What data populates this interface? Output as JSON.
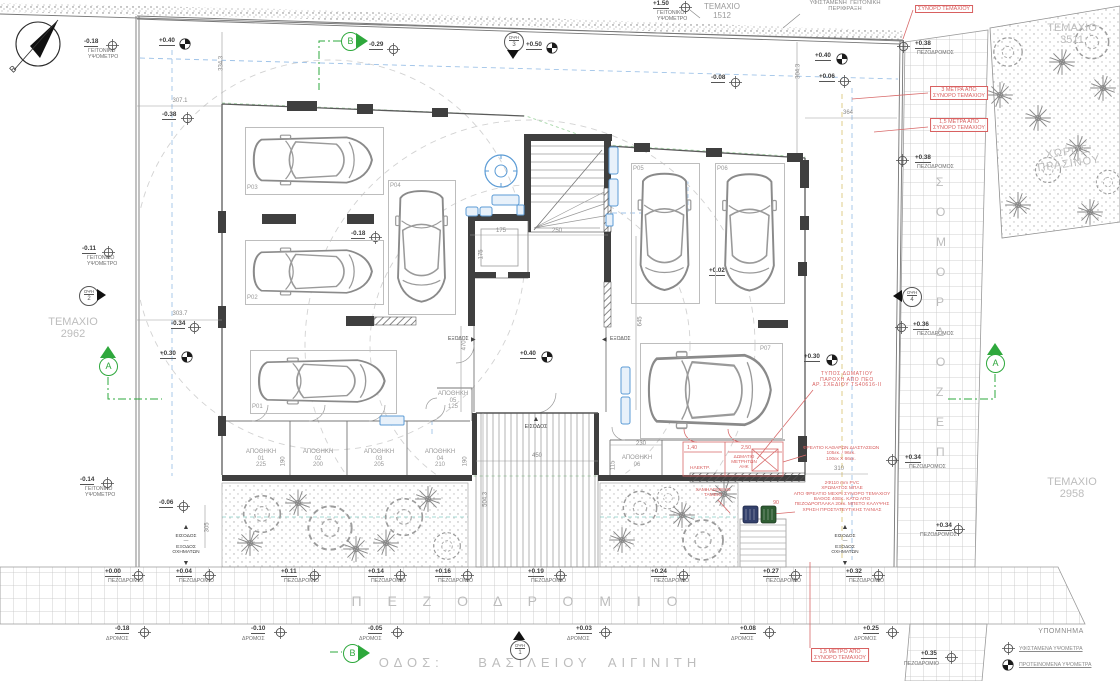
{
  "colors": {
    "accent_green": "#2ea83c",
    "annotation_red": "#d86060",
    "fixture_blue": "#5b9bd5",
    "line_gray": "#8a8a8a",
    "light_gray": "#bdbdbd",
    "wall_dark": "#3f3f3f"
  },
  "legend": {
    "title": "ΥΠΟΜΝΗΜΑ",
    "items": [
      {
        "sym": "existing",
        "text": "ΥΦΙΣΤΑΜΕΝΑ ΥΨΟΜΕΤΡΑ"
      },
      {
        "sym": "proposed",
        "text": "ΠΡΟΤΕΙΝΟΜΕΝΑ ΥΨΟΜΕΤΡΑ"
      }
    ]
  },
  "view_marker_label": "ΟΨΗ",
  "sidewalk_strip": {
    "letters": [
      "Σ",
      "Ο",
      "Μ",
      "Ο",
      "Ρ",
      "Δ",
      "Ο",
      "Ζ",
      "Ε",
      "Π"
    ],
    "x": 936,
    "y0": 176,
    "dy": 30
  },
  "labels": [
    {
      "t": "B",
      "x": 10,
      "y": 64,
      "c": "k",
      "s": 9,
      "rot": -45,
      "n": "compass-north-label"
    },
    {
      "t": "307.1",
      "x": 180,
      "y": 98,
      "a": "c",
      "n": "dimension-label"
    },
    {
      "t": "334.3",
      "x": 222,
      "y": 60,
      "a": "c",
      "rot": -90,
      "n": "dimension-label"
    },
    {
      "t": "304.3",
      "x": 799,
      "y": 68,
      "a": "c",
      "rot": -90,
      "n": "dimension-label"
    },
    {
      "t": "364",
      "x": 848,
      "y": 110,
      "a": "c",
      "n": "dimension-label"
    },
    {
      "t": "303.7",
      "x": 180,
      "y": 311,
      "a": "c",
      "n": "dimension-label"
    },
    {
      "t": "175",
      "x": 501,
      "y": 228,
      "a": "c",
      "n": "dimension-label"
    },
    {
      "t": "250",
      "x": 557,
      "y": 228,
      "a": "c",
      "n": "dimension-label"
    },
    {
      "t": "175",
      "x": 482,
      "y": 251,
      "a": "c",
      "rot": -90,
      "n": "dimension-label"
    },
    {
      "t": "645",
      "x": 641,
      "y": 318,
      "a": "c",
      "rot": -90,
      "n": "dimension-label"
    },
    {
      "t": "470",
      "x": 465,
      "y": 342,
      "a": "c",
      "rot": -90,
      "n": "dimension-label"
    },
    {
      "t": "504.3",
      "x": 486,
      "y": 496,
      "a": "c",
      "rot": -90,
      "n": "dimension-label"
    },
    {
      "t": "450",
      "x": 537,
      "y": 453,
      "a": "c",
      "n": "dimension-label"
    },
    {
      "t": "310",
      "x": 839,
      "y": 466,
      "a": "c",
      "n": "dimension-label"
    },
    {
      "t": "230",
      "x": 641,
      "y": 441,
      "a": "c",
      "n": "dimension-label"
    },
    {
      "t": "115",
      "x": 614,
      "y": 462,
      "a": "c",
      "rot": -90,
      "n": "dimension-label"
    },
    {
      "t": "190",
      "x": 284,
      "y": 458,
      "a": "c",
      "rot": -90,
      "n": "dimension-label"
    },
    {
      "t": "190",
      "x": 466,
      "y": 458,
      "a": "c",
      "rot": -90,
      "n": "dimension-label"
    },
    {
      "t": "305",
      "x": 208,
      "y": 524,
      "a": "c",
      "rot": -90,
      "n": "dimension-label"
    },
    {
      "t": "ΑΠΟΘΗΚΗ\n01\n225",
      "x": 261,
      "y": 449,
      "a": "c",
      "c": "g",
      "n": "room-label-apothiki-01"
    },
    {
      "t": "ΑΠΟΘΗΚΗ\n02\n200",
      "x": 318,
      "y": 449,
      "a": "c",
      "c": "g",
      "n": "room-label-apothiki-02"
    },
    {
      "t": "ΑΠΟΘΗΚΗ\n03\n205",
      "x": 379,
      "y": 449,
      "a": "c",
      "c": "g",
      "n": "room-label-apothiki-03"
    },
    {
      "t": "ΑΠΟΘΗΚΗ\n04\n210",
      "x": 440,
      "y": 449,
      "a": "c",
      "c": "g",
      "n": "room-label-apothiki-04"
    },
    {
      "t": "ΑΠΟΘΗΚΗ\n05\n125",
      "x": 453,
      "y": 391,
      "a": "c",
      "c": "g",
      "n": "room-label-apothiki-05"
    },
    {
      "t": "ΑΠΟΘΗΚΗ\n06",
      "x": 637,
      "y": 455,
      "a": "c",
      "c": "g",
      "n": "room-label-apothiki-06"
    },
    {
      "t": "ΤΕΜΑΧΙΟ\n1512",
      "x": 722,
      "y": 3,
      "a": "c",
      "c": "g",
      "s": 8,
      "n": "parcel-label-1512"
    },
    {
      "t": "ΤΕΜΑΧΙΟ\n3511",
      "x": 1072,
      "y": 22,
      "a": "c",
      "c": "lg",
      "s": 11,
      "n": "parcel-label-3511"
    },
    {
      "t": "ΤΕΜΑΧΙΟ\n2962",
      "x": 73,
      "y": 316,
      "a": "c",
      "c": "lg",
      "s": 11,
      "n": "parcel-label-2962"
    },
    {
      "t": "ΤΕΜΑΧΙΟ\n2958",
      "x": 1072,
      "y": 476,
      "a": "c",
      "c": "lg",
      "s": 11,
      "n": "parcel-label-2958"
    },
    {
      "t": "ΧΩΡΟΣ\nΠΡΑΣΙΝΟΥ",
      "x": 1068,
      "y": 146,
      "a": "c",
      "c": "lg",
      "s": 11,
      "rot": -8,
      "ls": 1,
      "n": "green-space-label"
    },
    {
      "t": "ΥΦΙΣΤΑΜΕΝΗ  ΓΕΙΤΟΝΙΚΗ\nΠΕΡΙΦΡΑΞΗ",
      "x": 845,
      "y": 0,
      "a": "c",
      "c": "d",
      "s": 5.8,
      "n": "existing-fence-label"
    },
    {
      "t": "Π Ε Ζ Ο Δ Ρ Ο Μ Ι Ο",
      "x": 520,
      "y": 594,
      "a": "c",
      "c": "lg",
      "s": 14,
      "ls": 11,
      "n": "sidewalk-watermark"
    },
    {
      "t": "ΟΔΟΣ:    ΒΑΣΙΛΕΙΟΥ  ΑΙΓΙΝΙΤΗ",
      "x": 540,
      "y": 656,
      "a": "c",
      "c": "lg",
      "s": 13,
      "ls": 5,
      "n": "street-name"
    },
    {
      "t": "ΕΙΣΟΔΟΣ",
      "x": 536,
      "y": 425,
      "a": "c",
      "c": "k",
      "s": 5.2,
      "n": "entrance-label"
    },
    {
      "t": "▲",
      "x": 536,
      "y": 416,
      "a": "c",
      "c": "k",
      "s": 7,
      "n": "entrance-arrow-icon"
    },
    {
      "t": "ΕΙΣΟΔΟΣ\n—\nΕΞΟΔΟΣ\nΟΧΗΜΑΤΩΝ",
      "x": 186,
      "y": 534,
      "a": "c",
      "c": "k",
      "s": 4.8,
      "n": "vehicle-entry-exit-left"
    },
    {
      "t": "▲",
      "x": 186,
      "y": 524,
      "a": "c",
      "c": "k",
      "s": 7,
      "n": "arrow-up-icon"
    },
    {
      "t": "▼",
      "x": 186,
      "y": 560,
      "a": "c",
      "c": "k",
      "s": 7,
      "n": "arrow-down-icon"
    },
    {
      "t": "ΕΙΣΟΔΟΣ\n—\nΕΞΟΔΟΣ\nΟΧΗΜΑΤΩΝ",
      "x": 845,
      "y": 534,
      "a": "c",
      "c": "k",
      "s": 4.8,
      "n": "vehicle-entry-exit-right"
    },
    {
      "t": "▲",
      "x": 845,
      "y": 524,
      "a": "c",
      "c": "k",
      "s": 7,
      "n": "arrow-up-icon"
    },
    {
      "t": "▼",
      "x": 845,
      "y": 560,
      "a": "c",
      "c": "k",
      "s": 7,
      "n": "arrow-down-icon"
    },
    {
      "t": "ΕΞΟΔΟΣ",
      "x": 448,
      "y": 337,
      "c": "k",
      "s": 5,
      "n": "exit-label-left"
    },
    {
      "t": "▶",
      "x": 471,
      "y": 337,
      "c": "k",
      "s": 6,
      "n": "arrow-right-icon"
    },
    {
      "t": "◀",
      "x": 602,
      "y": 337,
      "c": "k",
      "s": 6,
      "n": "arrow-left-icon"
    },
    {
      "t": "ΕΞΟΔΟΣ",
      "x": 610,
      "y": 337,
      "c": "k",
      "s": 5,
      "n": "exit-label-right"
    },
    {
      "t": "ΣΥΝΟΡΟ ΤΕΜΑΧΙΟΥ",
      "x": 944,
      "y": 5,
      "a": "c",
      "c": "r",
      "s": 5.4,
      "box": 1,
      "n": "red-note-boundary"
    },
    {
      "t": "3 ΜΕΤΡΑ ΑΠΟ\nΣΥΝΟΡΟ ΤΕΜΑΧΙΟΥ",
      "x": 959,
      "y": 86,
      "a": "c",
      "c": "r",
      "s": 5.4,
      "box": 1,
      "n": "red-note-3m-setback"
    },
    {
      "t": "1,5 ΜΕΤΡΑ ΑΠΟ\nΣΥΝΟΡΟ ΤΕΜΑΧΙΟΥ",
      "x": 959,
      "y": 118,
      "a": "c",
      "c": "r",
      "s": 5.4,
      "box": 1,
      "n": "red-note-1-5m-setback"
    },
    {
      "t": "1,5 ΜΕΤΡΟ ΑΠΟ\nΣΥΝΟΡΟ ΤΕΜΑΧΙΟΥ",
      "x": 840,
      "y": 648,
      "a": "c",
      "c": "r",
      "s": 5.4,
      "box": 1,
      "n": "red-note-1-5m-bottom"
    },
    {
      "t": "ΤΥΠΟΣ ΔΩΜΑΤΙΟΥ\nΠΑΡΟΧΗ ΑΠΟ ΠΕΟ\nΑΡ. ΣΧΕΔΙΟΥ TS40616-II",
      "x": 847,
      "y": 372,
      "a": "c",
      "c": "r",
      "s": 5,
      "ls": 0.6,
      "n": "red-note-room-type"
    },
    {
      "t": "ΦΡΕΑΤΙΟ ΚΑΘΑΡΩΝ ΔΙΑΣΤΑΣΕΩΝ\n105εκ. / 96εκ.\n100εκ Χ 66εκ.",
      "x": 841,
      "y": 446,
      "a": "c",
      "c": "r",
      "s": 4.8,
      "n": "red-note-manhole"
    },
    {
      "t": "2Φ110 mm PVC\nΧΡΩΜΑΤΟΣ ΜΠΛΕ\nΑΠΟ ΦΡΕΑΤΙΟ ΜΕΧΡΙ ΣΥΝΟΡΟ ΤΕΜΑΧΙΟΥ\nΒΑΘΟΣ 40ΕΚ. ΚΑΤΩ ΑΠΟ\nΠΕΖΟΔΡΟΠΛΑΚΑ 20εκ. ΜΠΕΤΟ ΚΑΛΥΨΗΣ\nΧΡΗΣΗ ΠΡΟΣΤΑΤΕΥΤΙΚΗΣ ΤΑΙΝΙΑΣ",
      "x": 842,
      "y": 481,
      "a": "c",
      "c": "r",
      "s": 4.8,
      "n": "red-note-pvc-duct"
    },
    {
      "t": "ΧΑΜΗΛΩΜΕΝΟ\nΤΑΜΕΙΟ",
      "x": 713,
      "y": 488,
      "a": "c",
      "c": "r",
      "s": 4.8,
      "n": "red-note-lowered-curb"
    },
    {
      "t": "ΗΛΕΚΤΡ.",
      "x": 700,
      "y": 466,
      "a": "c",
      "c": "r",
      "s": 4.8,
      "n": "room-label-electrical"
    },
    {
      "t": "ΔΩΜΑΤΙΟ\nΜΕΤΡΗΤΩΝ\nΑΗΚ",
      "x": 744,
      "y": 454,
      "a": "c",
      "c": "r",
      "s": 4.6,
      "n": "room-label-ahk-meters"
    },
    {
      "t": "1,40",
      "x": 692,
      "y": 446,
      "a": "c",
      "c": "r",
      "s": 5.2,
      "n": "red-dimension-label"
    },
    {
      "t": "2,50",
      "x": 746,
      "y": 446,
      "a": "c",
      "c": "r",
      "s": 5.2,
      "n": "red-dimension-label"
    },
    {
      "t": "90",
      "x": 776,
      "y": 501,
      "a": "c",
      "c": "r",
      "s": 5.2,
      "n": "red-dimension-label"
    },
    {
      "t": "♿",
      "x": 712,
      "y": 380,
      "a": "c",
      "c": "k",
      "s": 13,
      "n": "accessible-parking-icon"
    }
  ],
  "elevation_markers": [
    {
      "t": "e",
      "v": "-0.18",
      "x": 84,
      "y": 39,
      "cx": 112,
      "cy": 45,
      "sub": "ΓΕΙΤΟΝΙΚΟ\nΥΨΟΜΕΤΡΟ",
      "sx": 88,
      "sy": 49
    },
    {
      "t": "e",
      "v": "-0.38",
      "x": 162,
      "y": 112,
      "cx": 187,
      "cy": 118
    },
    {
      "t": "e",
      "v": "-0.29",
      "x": 369,
      "y": 42,
      "cx": 393,
      "cy": 49
    },
    {
      "t": "e",
      "v": "+1.50",
      "x": 653,
      "y": 1,
      "cx": 685,
      "cy": 7,
      "sub": "ΓΕΙΤΟΝΙΚΟ\nΥΨΟΜΕΤΡΟ",
      "sx": 657,
      "sy": 11
    },
    {
      "t": "e",
      "v": "-0.08",
      "x": 711,
      "y": 75,
      "cx": 735,
      "cy": 82
    },
    {
      "t": "e",
      "v": "+0.06",
      "x": 819,
      "y": 74,
      "cx": 844,
      "cy": 81
    },
    {
      "t": "e",
      "v": "+0.38",
      "x": 915,
      "y": 41,
      "cx": 903,
      "cy": 46,
      "sub": "ΠΕΖΟΔΡΟΜΟΣ",
      "sx": 917,
      "sy": 51
    },
    {
      "t": "e",
      "v": "-0.11",
      "x": 82,
      "y": 246,
      "cx": 108,
      "cy": 252,
      "sub": "ΓΕΙΤΟΝΙΚΟ\nΥΨΟΜΕΤΡΟ",
      "sx": 87,
      "sy": 256
    },
    {
      "t": "e",
      "v": "-0.34",
      "x": 171,
      "y": 321,
      "cx": 194,
      "cy": 327
    },
    {
      "t": "e",
      "v": "-0.18",
      "x": 351,
      "y": 231,
      "cx": 375,
      "cy": 237
    },
    {
      "t": "e",
      "v": "+0.02",
      "x": 709,
      "y": 268,
      "cx": 737,
      "cy": 275
    },
    {
      "t": "e",
      "v": "+0.38",
      "x": 915,
      "y": 155,
      "cx": 902,
      "cy": 160,
      "sub": "ΠΕΖΟΔΡΟΜΟΣ",
      "sx": 917,
      "sy": 165
    },
    {
      "t": "e",
      "v": "+0.36",
      "x": 913,
      "y": 322,
      "cx": 901,
      "cy": 327,
      "sub": "ΠΕΖΟΔΡΟΜΟΣ",
      "sx": 917,
      "sy": 332
    },
    {
      "t": "e",
      "v": "-0.06",
      "x": 159,
      "y": 500,
      "cx": 183,
      "cy": 506
    },
    {
      "t": "e",
      "v": "-0.14",
      "x": 80,
      "y": 477,
      "cx": 107,
      "cy": 483,
      "sub": "ΓΕΙΤΟΝΙΚΟ\nΥΨΟΜΕΤΡΟ",
      "sx": 85,
      "sy": 487
    },
    {
      "t": "e",
      "v": "+0.34",
      "x": 905,
      "y": 455,
      "cx": 892,
      "cy": 460,
      "sub": "ΠΕΖΟΔΡΟΜΟΣ",
      "sx": 909,
      "sy": 465
    },
    {
      "t": "e",
      "v": "+0.34",
      "x": 936,
      "y": 523,
      "cx": 958,
      "cy": 529,
      "sub": "ΠΕΖΟΔΡΟΜΟΣ",
      "sx": 920,
      "sy": 533
    },
    {
      "t": "e",
      "v": "+0.00",
      "x": 105,
      "y": 569,
      "cx": 138,
      "cy": 575,
      "sub": "ΠΕΖΟΔΡΟΜΙΟ",
      "sx": 108,
      "sy": 579
    },
    {
      "t": "e",
      "v": "+0.04",
      "x": 176,
      "y": 569,
      "cx": 209,
      "cy": 575,
      "sub": "ΠΕΖΟΔΡΟΜΙΟ",
      "sx": 179,
      "sy": 579
    },
    {
      "t": "e",
      "v": "+0.11",
      "x": 281,
      "y": 569,
      "cx": 314,
      "cy": 575,
      "sub": "ΠΕΖΟΔΡΟΜΙΟ",
      "sx": 284,
      "sy": 579
    },
    {
      "t": "e",
      "v": "+0.14",
      "x": 368,
      "y": 569,
      "cx": 400,
      "cy": 575,
      "sub": "ΠΕΖΟΔΡΟΜΙΟ",
      "sx": 371,
      "sy": 579
    },
    {
      "t": "e",
      "v": "+0.16",
      "x": 435,
      "y": 569,
      "cx": 467,
      "cy": 575,
      "sub": "ΠΕΖΟΔΡΟΜΙΟ",
      "sx": 438,
      "sy": 579
    },
    {
      "t": "e",
      "v": "+0.19",
      "x": 528,
      "y": 569,
      "cx": 560,
      "cy": 575,
      "sub": "ΠΕΖΟΔΡΟΜΙΟ",
      "sx": 531,
      "sy": 579
    },
    {
      "t": "e",
      "v": "+0.24",
      "x": 651,
      "y": 569,
      "cx": 683,
      "cy": 575,
      "sub": "ΠΕΖΟΔΡΟΜΙΟ",
      "sx": 654,
      "sy": 579
    },
    {
      "t": "e",
      "v": "+0.27",
      "x": 763,
      "y": 569,
      "cx": 795,
      "cy": 575,
      "sub": "ΠΕΖΟΔΡΟΜΙΟ",
      "sx": 766,
      "sy": 579
    },
    {
      "t": "e",
      "v": "+0.32",
      "x": 846,
      "y": 569,
      "cx": 878,
      "cy": 575,
      "sub": "ΠΕΖΟΔΡΟΜΙΟ",
      "sx": 849,
      "sy": 579
    },
    {
      "t": "e",
      "v": "-0.18",
      "x": 115,
      "y": 626,
      "cx": 144,
      "cy": 632,
      "sub": "ΔΡΟΜΟΣ",
      "sx": 106,
      "sy": 637
    },
    {
      "t": "e",
      "v": "-0.10",
      "x": 251,
      "y": 626,
      "cx": 280,
      "cy": 632,
      "sub": "ΔΡΟΜΟΣ",
      "sx": 242,
      "sy": 637
    },
    {
      "t": "e",
      "v": "-0.05",
      "x": 368,
      "y": 626,
      "cx": 397,
      "cy": 632,
      "sub": "ΔΡΟΜΟΣ",
      "sx": 359,
      "sy": 637
    },
    {
      "t": "e",
      "v": "+0.03",
      "x": 576,
      "y": 626,
      "cx": 605,
      "cy": 632,
      "sub": "ΔΡΟΜΟΣ",
      "sx": 567,
      "sy": 637
    },
    {
      "t": "e",
      "v": "+0.08",
      "x": 740,
      "y": 626,
      "cx": 769,
      "cy": 632,
      "sub": "ΔΡΟΜΟΣ",
      "sx": 731,
      "sy": 637
    },
    {
      "t": "e",
      "v": "+0.25",
      "x": 863,
      "y": 626,
      "cx": 892,
      "cy": 632,
      "sub": "ΔΡΟΜΟΣ",
      "sx": 854,
      "sy": 637
    },
    {
      "t": "e",
      "v": "+0.35",
      "x": 921,
      "y": 651,
      "cx": 951,
      "cy": 657,
      "sub": "ΠΕΖΟΔΡΟΜΙΟ",
      "sx": 904,
      "sy": 662
    },
    {
      "t": "p",
      "v": "+0.40",
      "x": 159,
      "y": 38,
      "cx": 185,
      "cy": 43
    },
    {
      "t": "p",
      "v": "+0.50",
      "x": 526,
      "y": 42,
      "cx": 552,
      "cy": 47
    },
    {
      "t": "p",
      "v": "+0.40",
      "x": 815,
      "y": 53,
      "cx": 842,
      "cy": 58
    },
    {
      "t": "p",
      "v": "+0.30",
      "x": 160,
      "y": 351,
      "cx": 187,
      "cy": 356
    },
    {
      "t": "p",
      "v": "+0.40",
      "x": 520,
      "y": 351,
      "cx": 547,
      "cy": 356
    },
    {
      "t": "p",
      "v": "+0.30",
      "x": 804,
      "y": 354,
      "cx": 832,
      "cy": 359
    }
  ],
  "parking_spots": [
    {
      "id": "P01",
      "x": 250,
      "y": 350,
      "w": 145,
      "h": 62,
      "o": "h",
      "lx": 252,
      "ly": 404
    },
    {
      "id": "P02",
      "x": 245,
      "y": 240,
      "w": 137,
      "h": 63,
      "o": "h",
      "lx": 247,
      "ly": 295
    },
    {
      "id": "P03",
      "x": 245,
      "y": 127,
      "w": 137,
      "h": 66,
      "o": "h",
      "lx": 247,
      "ly": 185
    },
    {
      "id": "P04",
      "x": 388,
      "y": 180,
      "w": 66,
      "h": 133,
      "o": "v",
      "lx": 390,
      "ly": 183
    },
    {
      "id": "P05",
      "x": 631,
      "y": 163,
      "w": 67,
      "h": 139,
      "o": "v",
      "lx": 633,
      "ly": 166
    },
    {
      "id": "P06",
      "x": 715,
      "y": 163,
      "w": 68,
      "h": 139,
      "o": "v",
      "lx": 717,
      "ly": 166
    },
    {
      "id": "P07",
      "x": 640,
      "y": 343,
      "w": 141,
      "h": 94,
      "o": "h",
      "lx": 760,
      "ly": 346,
      "dis": true
    }
  ],
  "section_markers": [
    {
      "label": "B",
      "x": 350,
      "y": 41,
      "tri": "right"
    },
    {
      "label": "B",
      "x": 352,
      "y": 653,
      "tri": "right"
    },
    {
      "label": "A",
      "x": 108,
      "y": 366,
      "tri": "up"
    },
    {
      "label": "A",
      "x": 995,
      "y": 363,
      "tri": "up"
    }
  ],
  "view_markers": [
    {
      "num": "3",
      "x": 513,
      "y": 41,
      "tri": "down"
    },
    {
      "num": "2",
      "x": 88,
      "y": 295,
      "tri": "right"
    },
    {
      "num": "4",
      "x": 911,
      "y": 296,
      "tri": "left"
    },
    {
      "num": "1",
      "x": 519,
      "y": 649,
      "tri": "up"
    }
  ]
}
